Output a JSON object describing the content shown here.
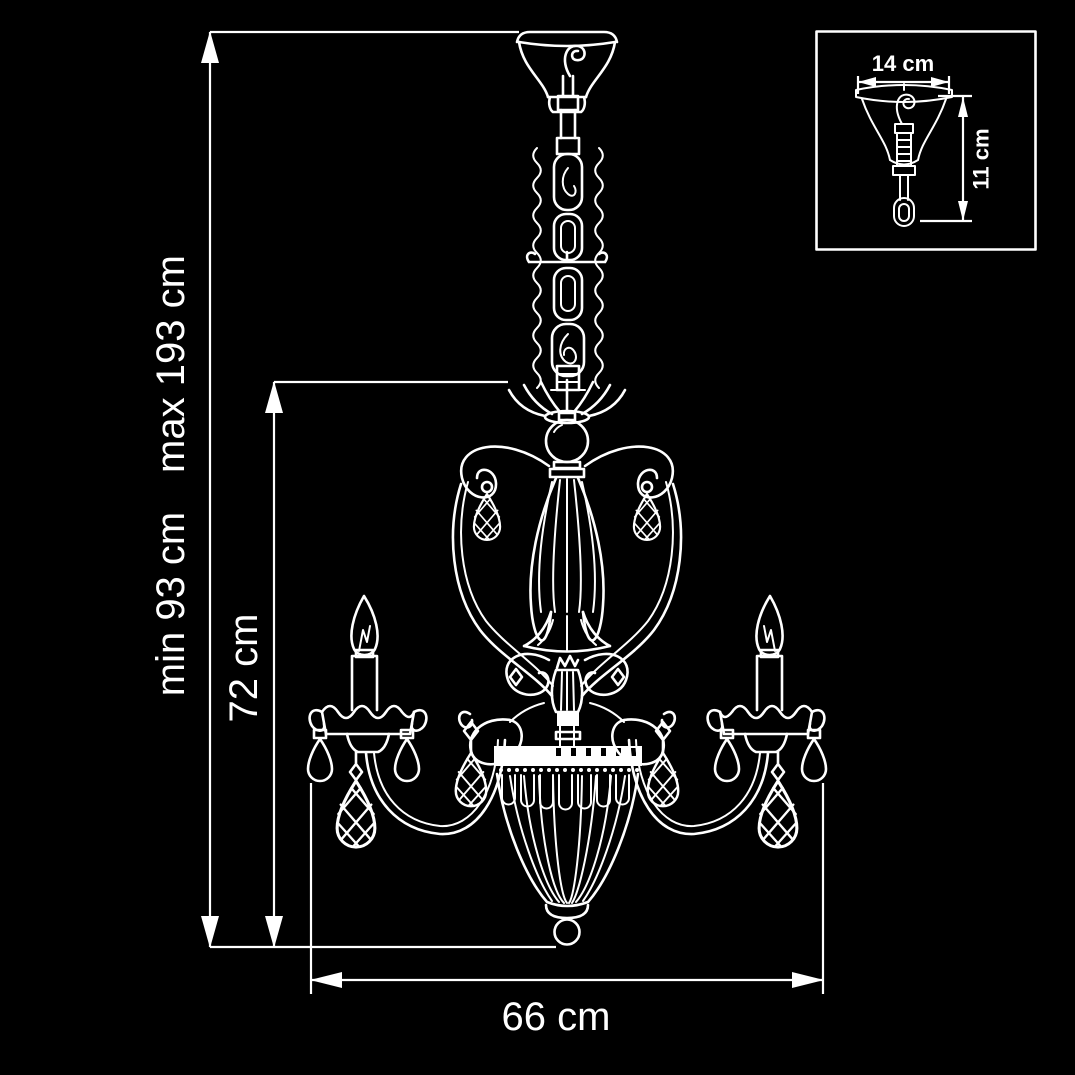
{
  "page": {
    "background_color": "#000000",
    "line_color": "#ffffff"
  },
  "main": {
    "description": "chandelier dimension drawing",
    "labels": {
      "height_max": "max 193 cm",
      "height_min": "min 93 cm",
      "inner_height": "72 cm",
      "width": "66 cm"
    }
  },
  "inset": {
    "description": "ceiling canopy detail drawing",
    "labels": {
      "width": "14 cm",
      "height": "11 cm"
    }
  }
}
